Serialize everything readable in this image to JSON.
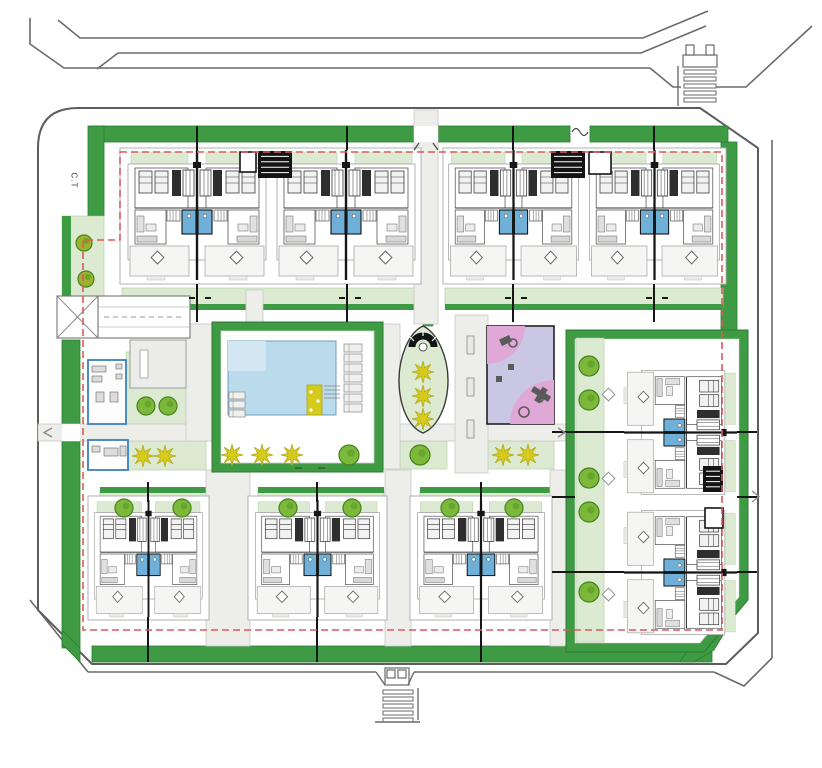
{
  "labels": {
    "ct": "C.T"
  },
  "palette": {
    "hedge": "#3f9b43",
    "hedgeStroke": "#2c7a31",
    "lawn": "#dcead2",
    "lawnStroke": "#a9cfa0",
    "lawnDark": "#3f9b43",
    "walk": "#ededea",
    "walkStroke": "#c6c6c2",
    "pool": "#b9dbeb",
    "poolLight": "#d3e7f3",
    "poolStroke": "#6f9cb8",
    "bath": "#6fb0d8",
    "red": "#d95c5c",
    "yellow": "#d6ca1c",
    "yellowStroke": "#b0a717",
    "tree": "#7cb83a",
    "treeStroke": "#44821f",
    "treeOlive": "#9db32c",
    "wall": "#161616",
    "road": "#6a6a6a",
    "site": "#5d5d5d",
    "unit": "#9a9a9a",
    "terrace": "#f5f5f3",
    "gray": "#ececea",
    "pink": "#dfa8d7",
    "lavender": "#c9c7e3",
    "equip": "#5a5a5a",
    "blue": "#3a7fc1"
  },
  "site": {
    "outline": "M78,108 H700 L758,148 V633 L726,664 H92 L38,610 V148 Q38,108 78,108 Z"
  },
  "roads": [
    "M58,20 L80,38 H643 L708,11",
    "M30,18 V44 L64,68 H650 L673,87 H681",
    "M716,87 H746 L812,26",
    "M97,69 L118,53 H641 L706,26",
    "M772,140 V658 L744,686 L714,672",
    "M88,672 H376",
    "M414,672 H714",
    "M88,672 L30,600"
  ],
  "stairs": [
    {
      "name": "stairs-top-right",
      "x": 684,
      "y": 70,
      "w": 32,
      "h": 34,
      "bars": 5,
      "rail": "M678,66 V106",
      "gate": [
        [
          683,
          55,
          34,
          12
        ],
        [
          686,
          45,
          8,
          10
        ],
        [
          706,
          45,
          8,
          10
        ]
      ]
    },
    {
      "name": "stairs-bottom",
      "x": 383,
      "y": 690,
      "w": 30,
      "h": 28,
      "bars": 5,
      "rail": "M418,688 V720 M375,722 H420",
      "gate": [
        [
          385,
          668,
          24,
          17
        ],
        [
          387,
          670,
          8,
          8
        ],
        [
          398,
          670,
          8,
          8
        ]
      ],
      "funnel": "M376,672 L385,685 M414,672 L408,685"
    }
  ],
  "greenBands": [
    [
      92,
      126,
      322,
      16
    ],
    [
      438,
      126,
      132,
      16
    ],
    [
      590,
      126,
      138,
      16
    ],
    [
      721,
      142,
      16,
      470
    ],
    [
      92,
      646,
      620,
      16
    ],
    [
      88,
      126,
      16,
      90
    ],
    [
      62,
      340,
      18,
      308
    ]
  ],
  "greenPolys": [
    [
      [
        721,
        612
      ],
      [
        737,
        612
      ],
      [
        714,
        650
      ],
      [
        694,
        662
      ],
      [
        680,
        662
      ],
      [
        706,
        620
      ]
    ],
    [
      [
        62,
        630
      ],
      [
        80,
        648
      ],
      [
        80,
        662
      ],
      [
        62,
        644
      ]
    ]
  ],
  "lawns": [
    [
      62,
      216,
      42,
      80
    ],
    [
      126,
      352,
      80,
      118
    ],
    [
      219,
      441,
      157,
      28
    ],
    [
      400,
      441,
      47,
      28
    ],
    [
      487,
      441,
      67,
      28
    ],
    [
      576,
      338,
      28,
      304
    ],
    [
      100,
      490,
      106,
      26
    ],
    [
      258,
      490,
      126,
      26
    ],
    [
      420,
      490,
      130,
      26
    ],
    [
      210,
      151,
      28,
      26
    ],
    [
      294,
      151,
      30,
      26
    ],
    [
      523,
      151,
      26,
      26
    ],
    [
      610,
      151,
      30,
      26
    ],
    [
      122,
      288,
      298,
      20
    ],
    [
      445,
      288,
      278,
      20
    ]
  ],
  "darkLawnEdges": [
    [
      100,
      487,
      106,
      6
    ],
    [
      258,
      487,
      126,
      6
    ],
    [
      420,
      487,
      130,
      6
    ],
    [
      122,
      304,
      298,
      6
    ],
    [
      445,
      304,
      278,
      6
    ],
    [
      62,
      216,
      9,
      80
    ]
  ],
  "medians": [
    [
      222,
      482,
      14,
      164
    ],
    [
      394,
      482,
      14,
      164
    ],
    [
      562,
      482,
      10,
      164
    ],
    [
      423,
      294,
      10,
      32
    ]
  ],
  "walkways": [
    [
      38,
      424,
      528,
      17
    ],
    [
      414,
      110,
      24,
      214
    ],
    [
      246,
      290,
      17,
      34
    ],
    [
      206,
      470,
      44,
      176
    ],
    [
      385,
      470,
      26,
      176
    ],
    [
      550,
      470,
      26,
      176
    ],
    [
      383,
      324,
      17,
      145
    ],
    [
      186,
      324,
      26,
      117
    ],
    [
      455,
      315,
      33,
      158
    ]
  ],
  "whiteGaps": [
    [
      414,
      126,
      24,
      16
    ],
    [
      246,
      322,
      17,
      10
    ],
    [
      302,
      462,
      16,
      10
    ],
    [
      721,
      490,
      16,
      14
    ],
    [
      62,
      424,
      18,
      17
    ]
  ],
  "pool": {
    "hedge": [
      212,
      322,
      171,
      150
    ],
    "deck": [
      221,
      331,
      153,
      132
    ],
    "water": [
      228,
      341,
      108,
      74
    ],
    "waterLight": [
      228,
      341,
      38,
      30
    ],
    "steps": [
      307,
      385,
      15,
      30
    ],
    "stripes": [
      324,
      386,
      16,
      16
    ],
    "loungersLeft": {
      "x": 229,
      "y": 392,
      "w": 16,
      "h": 7,
      "n": 3,
      "gap": 9
    },
    "loungersRight": {
      "x": 344,
      "y": 344,
      "w": 18,
      "h": 8,
      "n": 7,
      "gap": 10
    }
  },
  "rightEnclosure": {
    "hedgePath": "M566,330 H748 V600 L704,652 H566 Z",
    "innerPath": "M575,339 H739 V597 L700,643 H575 Z"
  },
  "playground": {
    "rect": [
      487,
      326,
      67,
      98
    ],
    "q1": "M487,326 h38 a38,38 0 0 1 -38,38 Z",
    "q2": "M554,424 v-44 a44,44 0 0 0 -44,44 Z"
  },
  "ovalIsland": {
    "path": "M423,326 C438,333 448,358 448,380 C448,405 438,427 423,433 C408,427 399,405 399,380 C399,358 408,333 423,326 Z",
    "hatchArc": "M412,347 A11,11 0 1 1 434,347",
    "hub": [
      423,
      347,
      4
    ]
  },
  "ramp": {
    "box": [
      57,
      296,
      41,
      42
    ],
    "lane": [
      98,
      296,
      92,
      42
    ],
    "dash": "M104,317 H184",
    "xlines": [
      "M57,296 L98,338",
      "M57,338 L98,296"
    ],
    "inner": [
      "M98,307 H190",
      "M98,327 H190"
    ]
  },
  "facility": {
    "building": [
      130,
      340,
      56,
      48
    ],
    "slot": [
      140,
      350,
      8,
      28
    ],
    "rooms": [
      [
        88,
        360,
        38,
        64
      ],
      [
        88,
        440,
        40,
        30
      ]
    ],
    "furniture": [
      [
        92,
        366,
        14,
        6
      ],
      [
        92,
        376,
        10,
        6
      ],
      [
        96,
        392,
        8,
        10
      ],
      [
        110,
        392,
        8,
        10
      ],
      [
        116,
        364,
        6,
        5
      ],
      [
        116,
        374,
        6,
        5
      ],
      [
        92,
        446,
        8,
        6
      ],
      [
        104,
        448,
        14,
        8
      ],
      [
        120,
        446,
        6,
        10
      ]
    ]
  },
  "blocks": [
    [
      120,
      148,
      301,
      136
    ],
    [
      443,
      148,
      283,
      136
    ],
    [
      88,
      496,
      121,
      124
    ],
    [
      248,
      496,
      139,
      124
    ],
    [
      410,
      496,
      142,
      124
    ]
  ],
  "modules": [
    {
      "t": [
        122,
        150
      ],
      "r": 0,
      "s": [
        1,
        1
      ]
    },
    {
      "t": [
        271,
        150
      ],
      "r": 0,
      "s": [
        1,
        1
      ]
    },
    {
      "t": [
        443,
        150
      ],
      "r": 0,
      "s": [
        0.94,
        1
      ]
    },
    {
      "t": [
        584,
        150
      ],
      "r": 0,
      "s": [
        0.94,
        1
      ]
    },
    {
      "t": [
        90,
        500
      ],
      "r": 0,
      "s": [
        0.78,
        0.9
      ]
    },
    {
      "t": [
        250,
        500
      ],
      "r": 0,
      "s": [
        0.9,
        0.9
      ]
    },
    {
      "t": [
        412,
        500
      ],
      "r": 0,
      "s": [
        0.92,
        0.9
      ]
    },
    {
      "t": [
        737,
        365
      ],
      "r": 90,
      "s": [
        0.9,
        0.87
      ]
    },
    {
      "t": [
        737,
        505
      ],
      "r": 90,
      "s": [
        0.9,
        0.87
      ]
    }
  ],
  "stairCores": [
    [
      258,
      151,
      34,
      27
    ],
    [
      551,
      151,
      34,
      27
    ],
    [
      703,
      466,
      20,
      26
    ]
  ],
  "coreBoxes": [
    [
      240,
      152,
      16,
      20
    ],
    [
      589,
      152,
      22,
      22
    ],
    [
      705,
      508,
      18,
      20
    ]
  ],
  "axisLines": [
    "M197,126 V150",
    "M347,126 V150",
    "M513,126 V150",
    "M654,126 V150",
    "M197,284 V322",
    "M347,284 V322",
    "M513,284 V322",
    "M654,284 V322",
    "M148,617 V662",
    "M317,617 V662",
    "M481,617 V662",
    "M148,482 V502",
    "M317,482 V502",
    "M481,482 V502",
    "M552,432 H624",
    "M737,432 H757",
    "M552,572 H624",
    "M737,572 H757",
    "M737,497 H757",
    "M552,497 H575"
  ],
  "axisTicks": [
    [
      189,
      298
    ],
    [
      205,
      298
    ],
    [
      339,
      298
    ],
    [
      355,
      298
    ],
    [
      505,
      298
    ],
    [
      521,
      298
    ],
    [
      646,
      298
    ],
    [
      662,
      298
    ]
  ],
  "gateMarks": [
    "M414,150 l5,-7",
    "M438,150 l-5,-7",
    "M302,468 h-7",
    "M318,468 h7",
    "M572,132 q4,-7 8,0 q4,7 8,0"
  ],
  "arrows": [
    "M52,428 l-8,4.5 8,4.5",
    "M558,428 l7,4.5 -7,4.5",
    "M752,491 l7,5.5 -7,5.5"
  ],
  "benches": [
    [
      467,
      336,
      7,
      18
    ],
    [
      467,
      378,
      7,
      18
    ],
    [
      467,
      420,
      7,
      18
    ]
  ],
  "tables": [
    [
      604,
      390,
      9,
      9
    ],
    [
      604,
      474,
      9,
      9
    ],
    [
      604,
      590,
      9,
      9
    ]
  ],
  "equipment": {
    "rects": [
      [
        500,
        337,
        11,
        7,
        -25
      ],
      [
        531,
        391,
        20,
        6,
        32
      ],
      [
        538,
        387,
        6,
        16,
        32
      ],
      [
        508,
        364,
        6,
        6,
        0
      ],
      [
        496,
        376,
        6,
        6,
        0
      ]
    ],
    "circles": [
      [
        513,
        343,
        4
      ],
      [
        524,
        412,
        5
      ],
      [
        540,
        399,
        3
      ]
    ]
  },
  "trees": [
    [
      84,
      243,
      8,
      1
    ],
    [
      86,
      279,
      8,
      1
    ],
    [
      146,
      406,
      9,
      0
    ],
    [
      168,
      406,
      9,
      0
    ],
    [
      349,
      455,
      10,
      0
    ],
    [
      420,
      455,
      10,
      0
    ],
    [
      589,
      366,
      10,
      0
    ],
    [
      589,
      400,
      10,
      0
    ],
    [
      589,
      478,
      10,
      0
    ],
    [
      589,
      512,
      10,
      0
    ],
    [
      589,
      592,
      10,
      0
    ],
    [
      124,
      508,
      9,
      0
    ],
    [
      182,
      508,
      9,
      0
    ],
    [
      288,
      508,
      9,
      0
    ],
    [
      352,
      508,
      9,
      0
    ],
    [
      450,
      508,
      9,
      0
    ],
    [
      514,
      508,
      9,
      0
    ]
  ],
  "flowers": [
    [
      143,
      456
    ],
    [
      165,
      456
    ],
    [
      232,
      455
    ],
    [
      262,
      455
    ],
    [
      292,
      455
    ],
    [
      423,
      372
    ],
    [
      423,
      396
    ],
    [
      423,
      419
    ],
    [
      503,
      455
    ],
    [
      528,
      455
    ]
  ],
  "redBoundary": "M120,152 H722 V630 H83 V240 H120 Z"
}
